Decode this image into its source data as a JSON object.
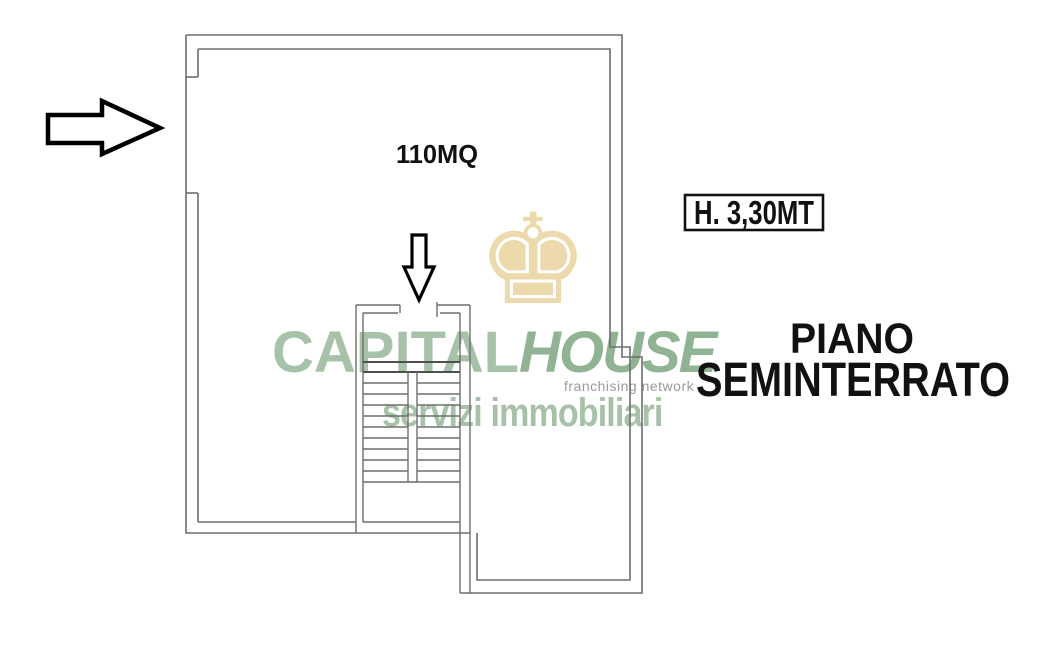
{
  "plan": {
    "area_label": "110MQ",
    "ceiling_height_label": "H. 3,30MT",
    "floor_title": {
      "line1": "PIANO",
      "line2": "SEMINTERRATO"
    }
  },
  "watermark": {
    "brand_primary": "CAPITAL",
    "brand_secondary": "HOUSE",
    "tagline": "franchising network",
    "subtitle": "servizi immobiliari",
    "crown_glyph": "♚"
  },
  "icons": {
    "entry_arrow": "right-arrow-icon",
    "stair_arrow": "down-arrow-icon",
    "crown": "crown-icon"
  },
  "colors": {
    "background": "#ffffff",
    "wall_gray": "#6e6e6e",
    "annotation_black": "#111111",
    "brand_green": "#a7c2a8",
    "brand_green_dark": "#90b394",
    "tagline_gray": "#9b9b9b",
    "crown_gold": "#ead5a4"
  }
}
